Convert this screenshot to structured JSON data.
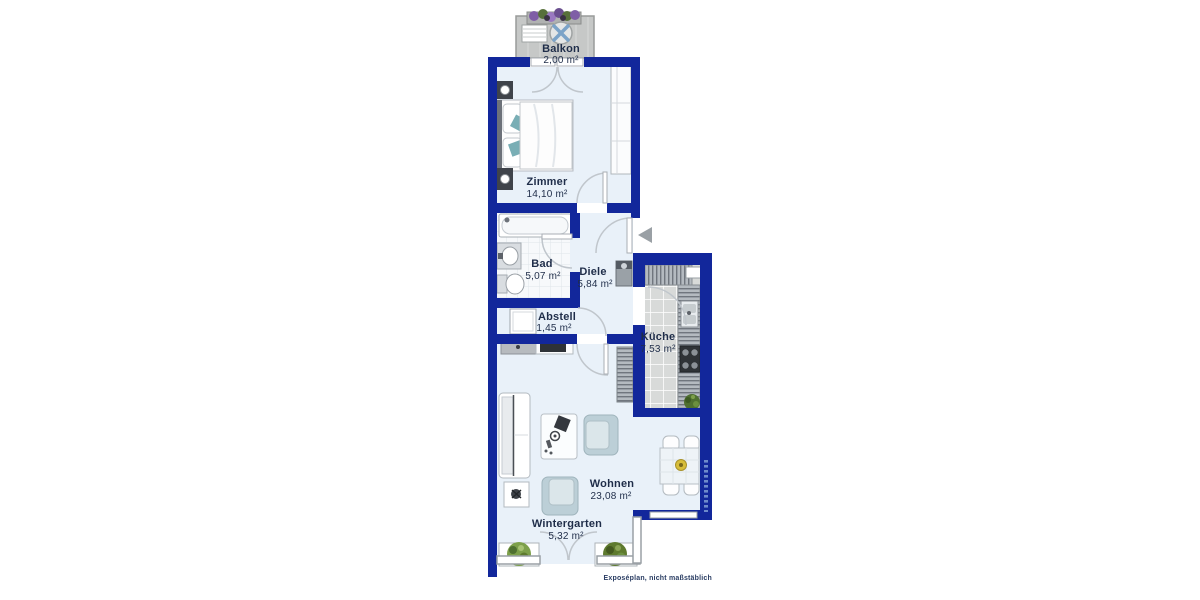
{
  "meta": {
    "caption": "Exposéplan, nicht maßstäblich"
  },
  "palette": {
    "wall": "#12279b",
    "floor": "#e9f1f9",
    "bad_floor": "#f7f9fb",
    "kitchen_floor": "#d8dad9",
    "balcony_floor": "#c6c8c7",
    "counter_gray": "#b4bac0",
    "armchair_blue": "#bccfd7",
    "pillow_teal": "#79aeb5",
    "plant_green": "#4f7030",
    "bowl_yellow": "#d7bd3a",
    "label_text": "#1f2d49",
    "arrow_gray": "#9aa0a5"
  },
  "rooms": [
    {
      "key": "balkon",
      "name": "Balkon",
      "area": "2,00 m²"
    },
    {
      "key": "zimmer",
      "name": "Zimmer",
      "area": "14,10 m²"
    },
    {
      "key": "bad",
      "name": "Bad",
      "area": "5,07 m²"
    },
    {
      "key": "diele",
      "name": "Diele",
      "area": "5,84 m²"
    },
    {
      "key": "abstell",
      "name": "Abstell",
      "area": "1,45 m²"
    },
    {
      "key": "kueche",
      "name": "Küche",
      "area": "7,53 m²"
    },
    {
      "key": "wohnen",
      "name": "Wohnen",
      "area": "23,08 m²"
    },
    {
      "key": "wintergarten",
      "name": "Wintergarten",
      "area": "5,32 m²"
    }
  ]
}
